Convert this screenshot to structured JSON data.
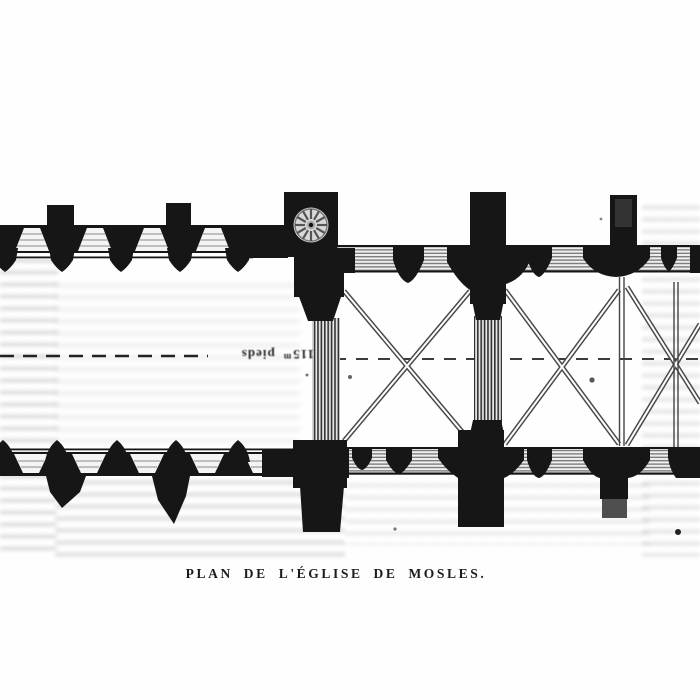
{
  "page": {
    "caption": "PLAN DE L'ÉGLISE DE MOSLES.",
    "paper_color": "#fefefe",
    "ink_color": "#161616",
    "hatch_color": "#6a6a6a",
    "bleedthrough_color": "#8a8a8a"
  },
  "plan": {
    "scale_label": {
      "value": "115",
      "sup": "m",
      "unit": "pieds"
    },
    "centerline_style": "dashed"
  }
}
